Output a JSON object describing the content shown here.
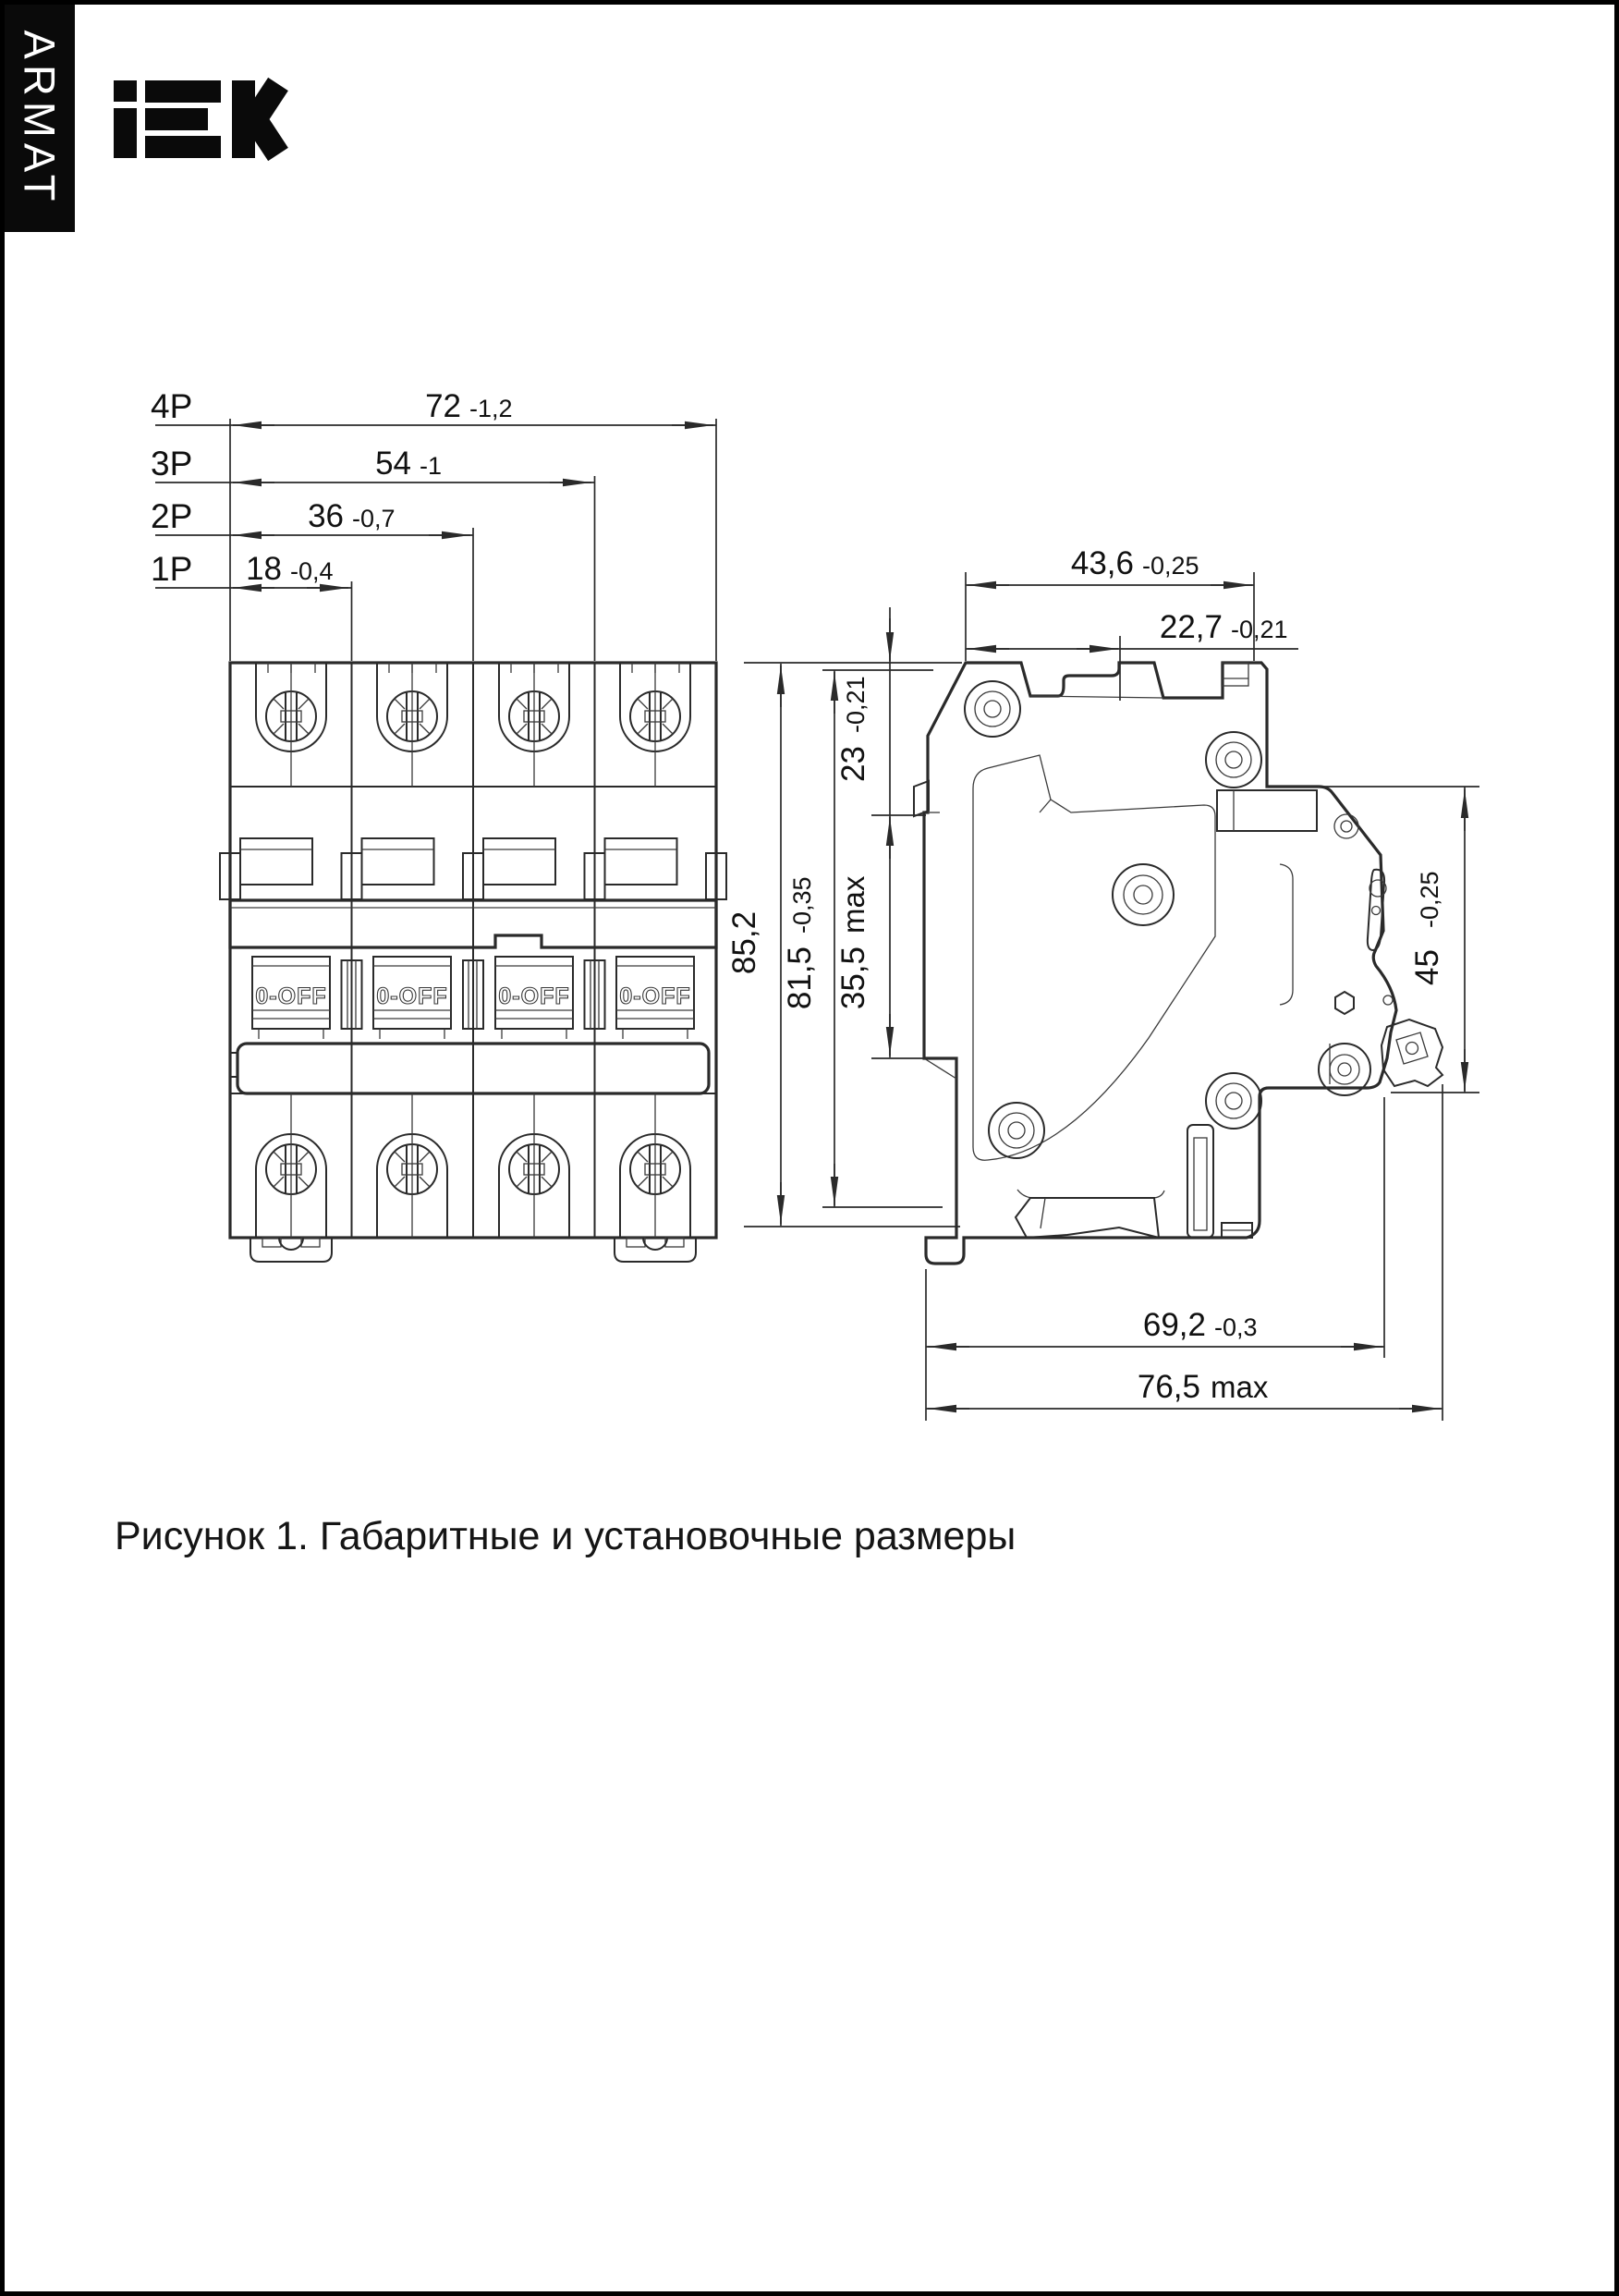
{
  "brand": {
    "banner": "ARMAT",
    "logo": "IEK"
  },
  "caption": "Рисунок 1. Габаритные и установочные размеры",
  "front_view": {
    "toggle_label": "0-OFF",
    "dims": [
      {
        "pole": "4P",
        "value": "72",
        "tol": "-1,2"
      },
      {
        "pole": "3P",
        "value": "54",
        "tol": "-1"
      },
      {
        "pole": "2P",
        "value": "36",
        "tol": "-0,7"
      },
      {
        "pole": "1P",
        "value": "18",
        "tol": "-0,4"
      }
    ]
  },
  "side_view": {
    "dims": {
      "depth_total": {
        "value": "43,6",
        "tol": "-0,25"
      },
      "depth_front": {
        "value": "22,7",
        "tol": "-0,21"
      },
      "height_total": {
        "value": "85,2",
        "tol": ""
      },
      "height_body": {
        "value": "81,5",
        "tol": "-0,35"
      },
      "top_to_nose": {
        "value": "23",
        "tol": "-0,21"
      },
      "nose_height": {
        "value": "35,5",
        "tol": "max"
      },
      "din_zone": {
        "value": "45",
        "tol": "-0,25"
      },
      "bottom_depth": {
        "value": "69,2",
        "tol": "-0,3"
      },
      "bottom_max": {
        "value": "76,5",
        "tol": "max"
      }
    }
  }
}
